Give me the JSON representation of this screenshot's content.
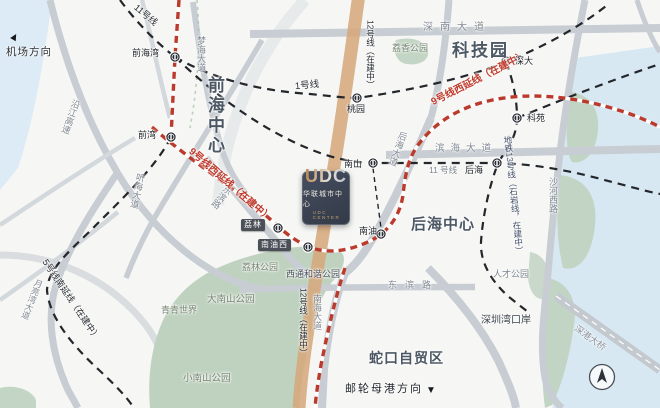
{
  "brand": {
    "logo_main": "UDC",
    "logo_cn": "华联城市中心",
    "logo_en": "UDC CENTER"
  },
  "districts": {
    "qianhai": "前海中心",
    "tech_park": "科技园",
    "houhai": "后海中心",
    "shekou": "蛇口自贸区"
  },
  "stations": {
    "qianhaiwan": "前海湾",
    "qianwan": "前湾",
    "taoyuan": "桃园",
    "shenda": "深大",
    "keyuan": "科苑",
    "nanshan": "南山",
    "houhai": "后海",
    "nanyou": "南油",
    "lilin": "荔林",
    "nanyouxi": "南油西"
  },
  "lines": {
    "line1": "1号线",
    "line11": "11号线",
    "line11_small": "11 号线",
    "line9_west": "9号线西延线（在建中）",
    "line5_south": "5号线南延线（在建中）",
    "line12": "12号线（在建中）",
    "line13": "地铁13号线（石岩线，在建中）"
  },
  "roads": {
    "shennan": "深南大道",
    "binhai": "滨海大道",
    "dongbin": "东滨路",
    "yanjiang": "沿江高速",
    "menghai": "梦海大道",
    "tinghai": "听海大道",
    "yueliangwan": "月亮湾大道",
    "nanhai": "南海大道",
    "houhai_rd": "后海大道",
    "shahexi": "沙河西路",
    "bridge": "深港大桥"
  },
  "parks": {
    "lixiang": "荔香公园",
    "lilin": "荔林公园",
    "xitong": "西通和谐公园",
    "dananshan": "大南山公园",
    "xiaonanshan": "小南山公园",
    "qingqing": "青青世界",
    "rencai": "人才公园"
  },
  "places": {
    "bay_port": "深圳湾口岸",
    "airport_dir": "机场方向",
    "cruise_dir": "邮轮母港方向"
  },
  "colors": {
    "construction_red": "#bb3a2c",
    "metro_black": "#23272c",
    "band_orange": "#d6a87c",
    "water_blue": "#d7e8f3",
    "park_green": "#bfd2bf",
    "road_gray": "#c7cdd3",
    "logo_bg": "#3a4150",
    "logo_gold": "#c2955f"
  }
}
